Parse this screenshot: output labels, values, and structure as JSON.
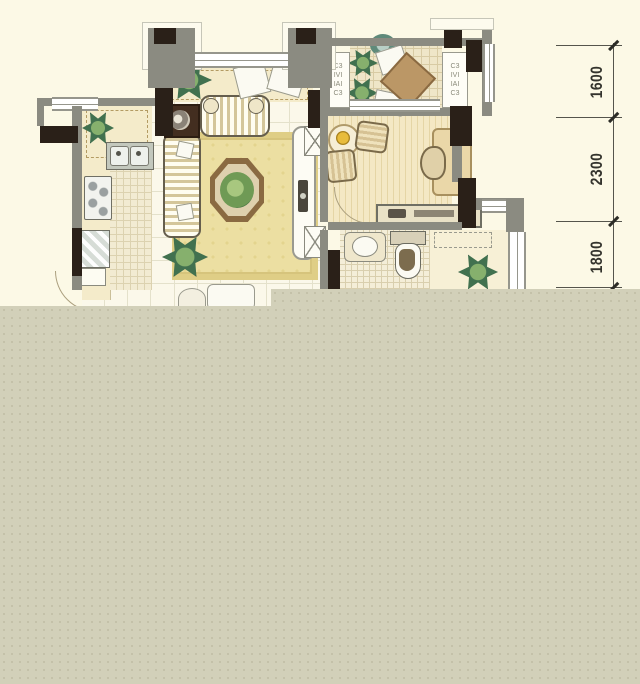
{
  "colors": {
    "background": "#fcf9e6",
    "cover_block": "#d2d0b9",
    "wall": "#8b8b81",
    "structural_column": "#2a2018",
    "rug": "#ecdfa2",
    "wood_floor": "#f2e5c0",
    "plant_green": "#3f7050",
    "dimension_text": "#34342d"
  },
  "dimension_column": {
    "labels": [
      {
        "value": "1600"
      },
      {
        "value": "2300"
      },
      {
        "value": "1800"
      }
    ]
  },
  "ac_platforms": {
    "marks": [
      "C3",
      "IVI",
      "IAI",
      "C3"
    ]
  }
}
